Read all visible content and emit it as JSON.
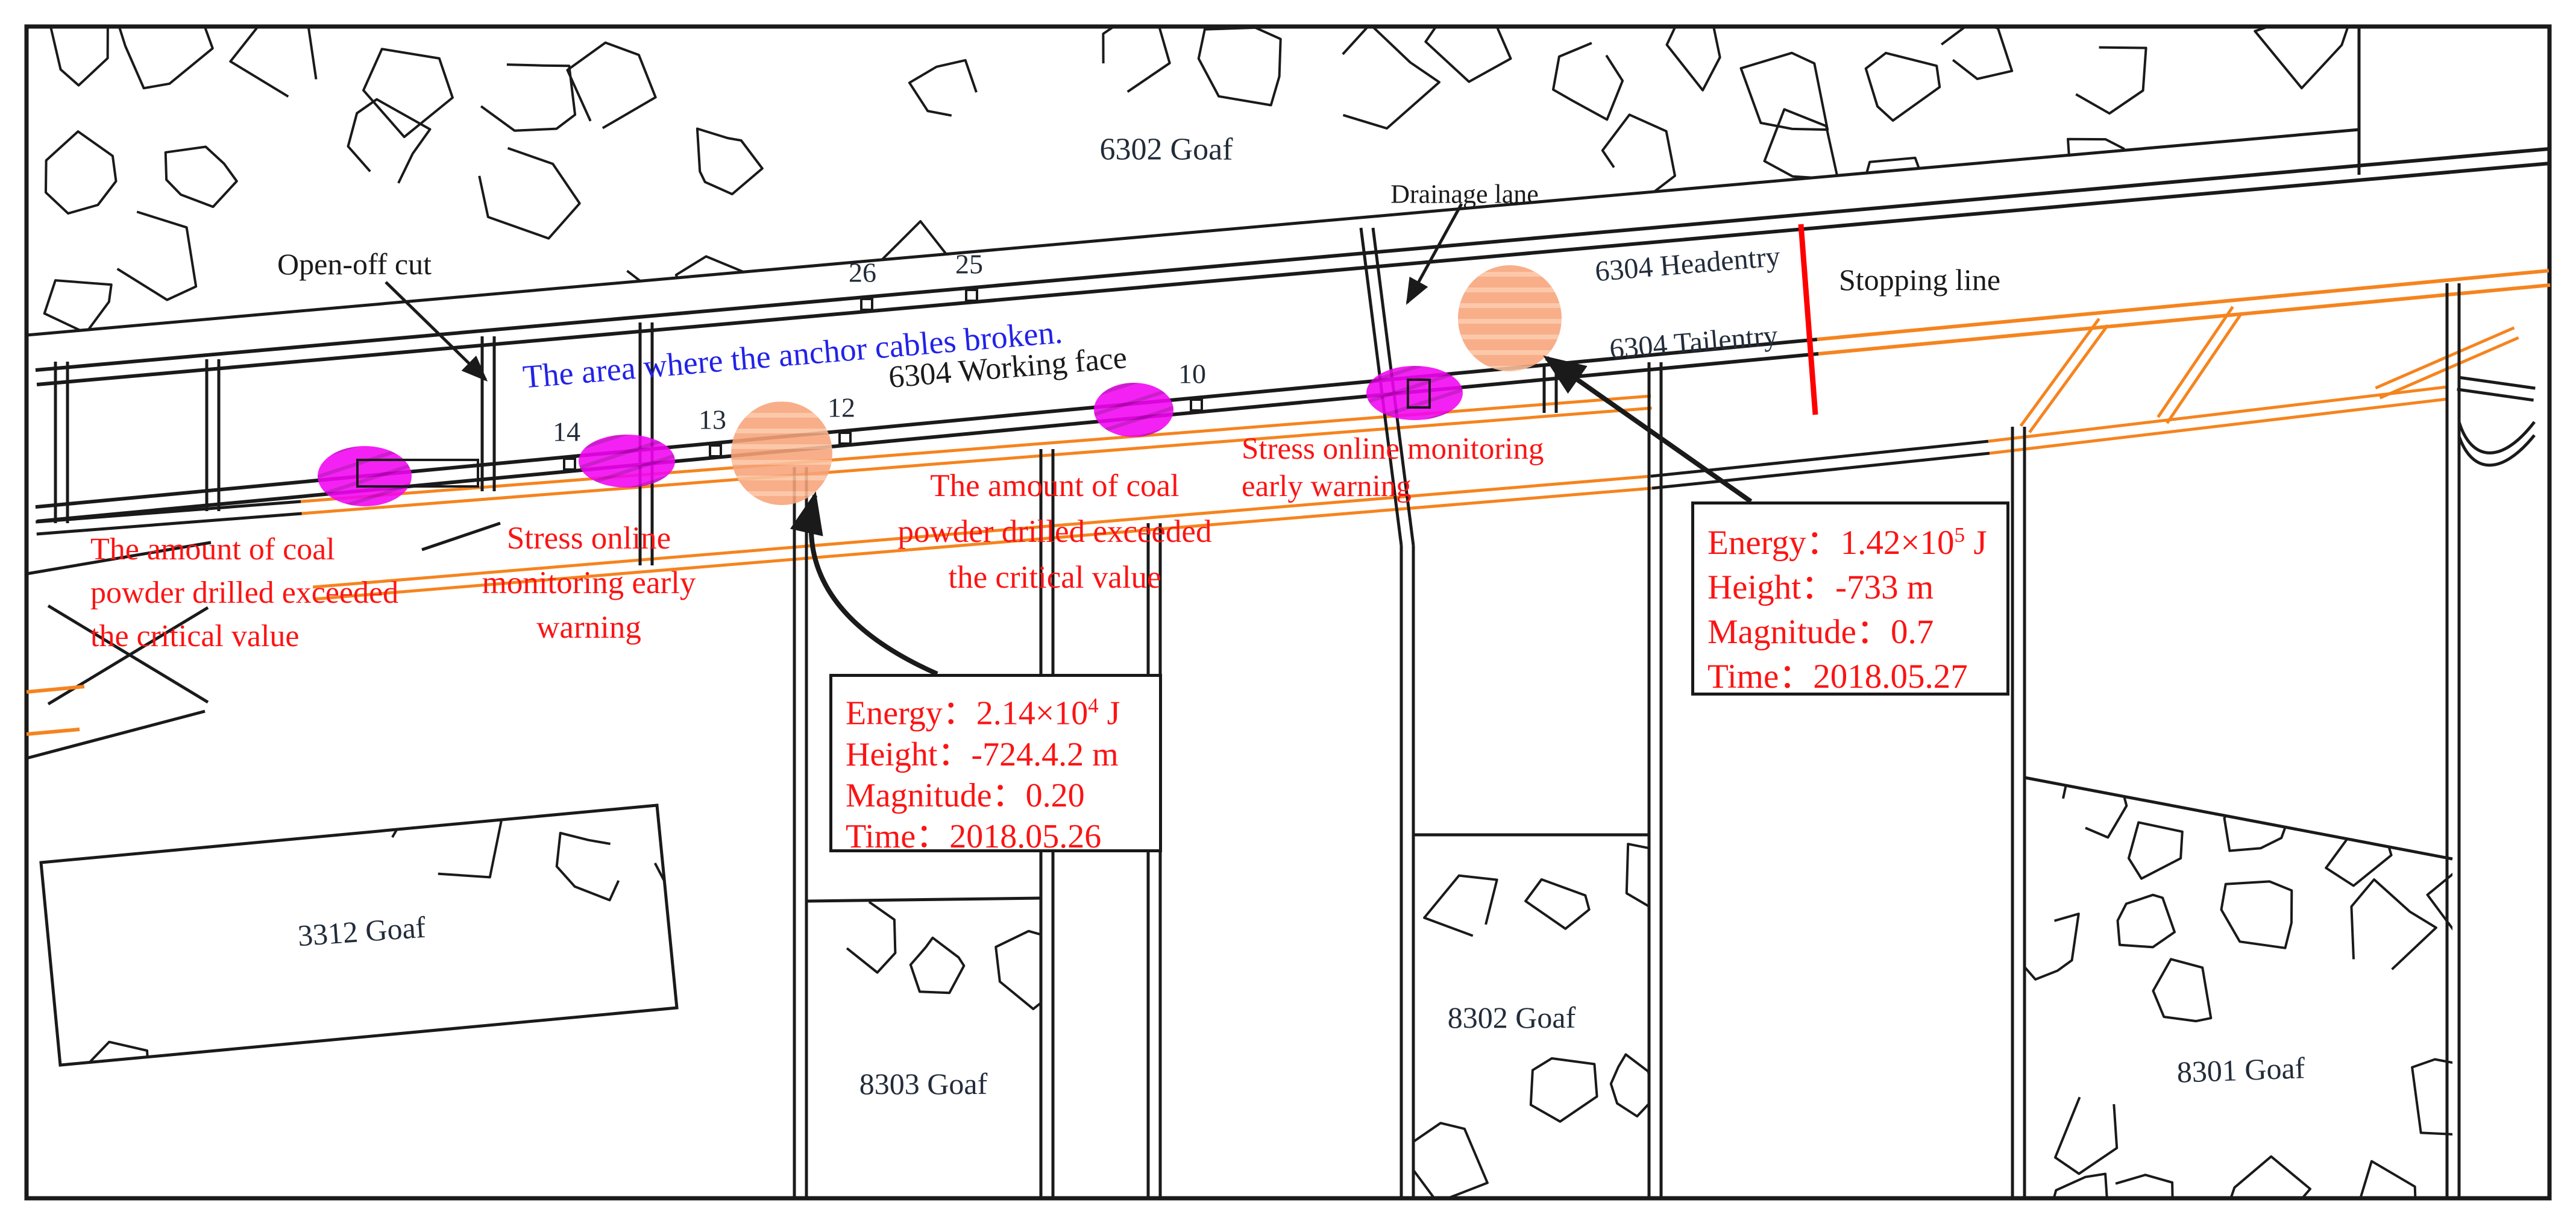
{
  "colors": {
    "line": "#1a1a1a",
    "roadway_orange": "#f5841e",
    "warning_red": "#fb1414",
    "stopping_red": "#ff0000",
    "note_blue": "#2222e8",
    "magenta": "#f203f2",
    "magenta_hatch": "#c400c4",
    "event_orange": "#f7a379",
    "event_orange_hatch": "#fbc19e",
    "label_dark": "#222c3a"
  },
  "goafs": {
    "g6302": "6302 Goaf",
    "g3312": "3312 Goaf",
    "g8303": "8303 Goaf",
    "g8302": "8302 Goaf",
    "g8301": "8301 Goaf"
  },
  "labels": {
    "open_off_cut": "Open-off cut",
    "drainage_lane": "Drainage lane",
    "working_face": "6304 Working face",
    "headentry": "6304 Headentry",
    "tailentry": "6304 Tailentry",
    "stopping_line": "Stopping line"
  },
  "notes": {
    "anchor_cables": "The area where the anchor cables broken."
  },
  "stations": {
    "s26": "26",
    "s25": "25",
    "s14": "14",
    "s13": "13",
    "s12": "12",
    "s10": "10"
  },
  "warnings": {
    "coal_powder_left": {
      "line1": "The amount of coal",
      "line2": "powder drilled exceeded",
      "line3": "the critical value"
    },
    "stress_left": {
      "line1": "Stress online",
      "line2": "monitoring early",
      "line3": "warning"
    },
    "coal_powder_mid": {
      "line1": "The amount of coal",
      "line2": "powder drilled exceeded",
      "line3": "the critical value"
    },
    "stress_right": {
      "line1": "Stress online monitoring",
      "line2": "early warning"
    }
  },
  "events": {
    "e1": {
      "energy_label": "Energy：",
      "energy_base": "2.14×10",
      "energy_exp": "4",
      "energy_unit": " J",
      "height": "Height：-724.4.2 m",
      "magnitude": "Magnitude：0.20",
      "time": "Time：2018.05.26"
    },
    "e2": {
      "energy_label": "Energy：",
      "energy_base": "1.42×10",
      "energy_exp": "5",
      "energy_unit": " J",
      "height": "Height：-733 m",
      "magnitude": "Magnitude：0.7",
      "time": "Time：2018.05.27"
    }
  }
}
